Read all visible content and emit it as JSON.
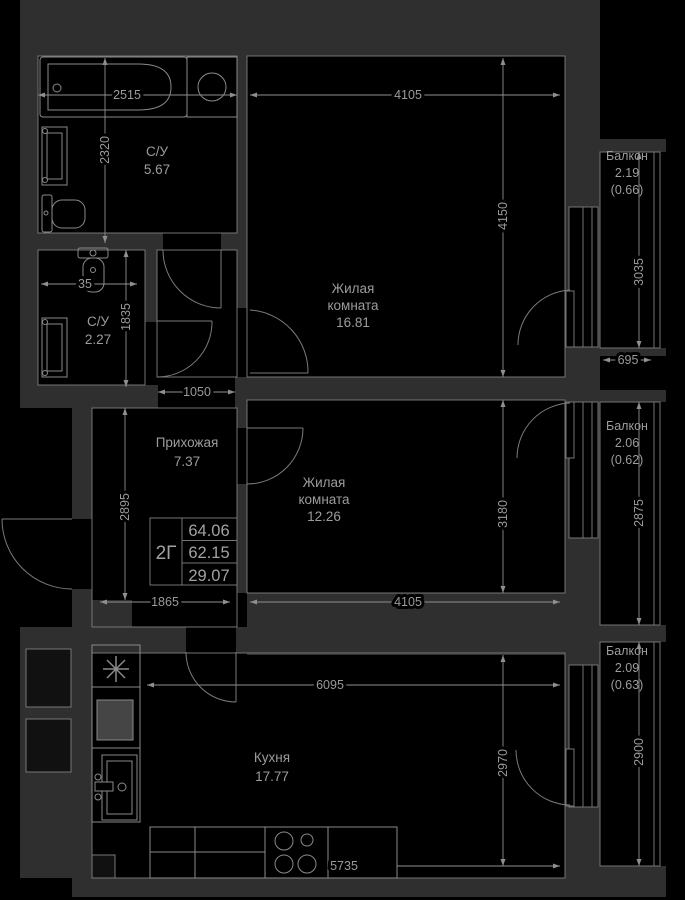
{
  "apartment": {
    "type": "2Г",
    "total_area": "64.06",
    "area_without_balconies": "62.15",
    "living_area": "29.07"
  },
  "rooms": {
    "bathroom1": {
      "name": "С/У",
      "area": "5.67"
    },
    "bathroom2": {
      "name": "С/У",
      "area": "2.27"
    },
    "hallway": {
      "name": "Прихожая",
      "area": "7.37"
    },
    "living1": {
      "name_line1": "Жилая",
      "name_line2": "комната",
      "area": "16.81"
    },
    "living2": {
      "name_line1": "Жилая",
      "name_line2": "комната",
      "area": "12.26"
    },
    "kitchen": {
      "name": "Кухня",
      "area": "17.77"
    }
  },
  "balconies": {
    "b1": {
      "name": "Балкон",
      "area": "2.19",
      "coefficient": "(0.66)"
    },
    "b2": {
      "name": "Балкон",
      "area": "2.06",
      "coefficient": "(0.62)"
    },
    "b3": {
      "name": "Балкон",
      "area": "2.09",
      "coefficient": "(0.63)"
    }
  },
  "dimensions_mm": {
    "bath1_width": "2515",
    "bath1_depth": "2320",
    "room1_width": "4105",
    "room1_depth": "4150",
    "balcony1_height": "3035",
    "balcony1_width": "695",
    "bath2_width": "35",
    "bath2_depth": "1835",
    "hall_passage": "1050",
    "hall_depth": "2895",
    "hall_width": "1865",
    "room2_width": "4105",
    "room2_depth": "3180",
    "balcony2_height": "2875",
    "kitchen_width": "6095",
    "kitchen_depth": "2970",
    "balcony3_height": "2900",
    "kitchen_bottom_width": "5735"
  },
  "colors": {
    "background": "#000000",
    "wall": "#2f2f2f",
    "outline": "#757575",
    "dimension": "#8f8f8f",
    "label": "#9c9c9c"
  }
}
